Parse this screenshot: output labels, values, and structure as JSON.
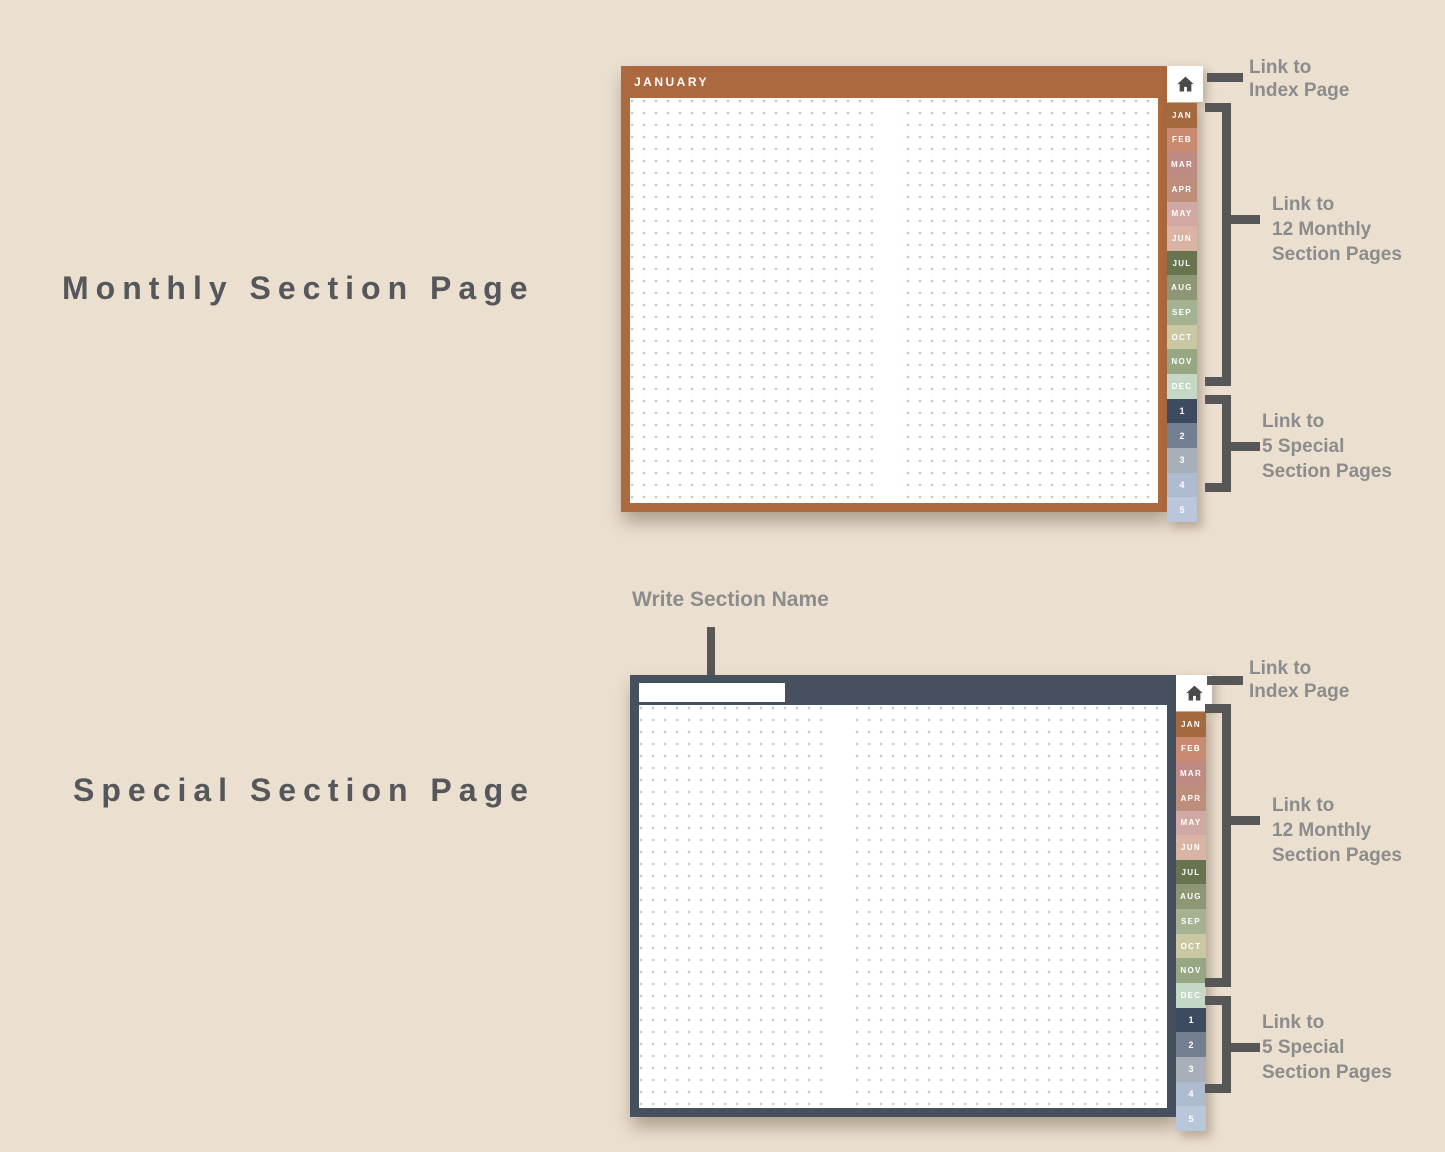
{
  "titles": {
    "monthly": "Monthly Section Page",
    "special": "Special Section Page"
  },
  "monthly_planner": {
    "header": "JANUARY"
  },
  "special_planner": {
    "write_label": "Write Section Name",
    "name_value": ""
  },
  "month_tabs": [
    {
      "label": "JAN",
      "color": "#a5693f"
    },
    {
      "label": "FEB",
      "color": "#c98a70"
    },
    {
      "label": "MAR",
      "color": "#bd8a84"
    },
    {
      "label": "APR",
      "color": "#bd8e7c"
    },
    {
      "label": "MAY",
      "color": "#d0a9a4"
    },
    {
      "label": "JUN",
      "color": "#d9b4a5"
    },
    {
      "label": "JUL",
      "color": "#68734f"
    },
    {
      "label": "AUG",
      "color": "#8d9775"
    },
    {
      "label": "SEP",
      "color": "#a4b291"
    },
    {
      "label": "OCT",
      "color": "#c9c8a2"
    },
    {
      "label": "NOV",
      "color": "#97a784"
    },
    {
      "label": "DEC",
      "color": "#c5d8c6"
    }
  ],
  "special_tabs": [
    {
      "label": "1",
      "color": "#3d4a5f"
    },
    {
      "label": "2",
      "color": "#737f90"
    },
    {
      "label": "3",
      "color": "#a9afb8"
    },
    {
      "label": "4",
      "color": "#aebbce"
    },
    {
      "label": "5",
      "color": "#bac7db"
    }
  ],
  "annotations": {
    "index": {
      "lines": [
        "Link to",
        "Index Page"
      ]
    },
    "months": {
      "lines": [
        "Link to",
        "12 Monthly",
        "Section Pages"
      ]
    },
    "specials": {
      "lines": [
        "Link to",
        "5 Special",
        "Section Pages"
      ]
    }
  },
  "icons": {
    "home": "⌂"
  },
  "colors": {
    "background": "#ebdfd0",
    "title_text": "#55575b",
    "annotation_text": "#8c8c8c",
    "connector": "#575757",
    "monthly_accent": "#ac683e",
    "special_accent": "#46505f",
    "page": "#ffffff",
    "dot": "#c7c7cc",
    "home_icon": "#4a4a4a"
  }
}
